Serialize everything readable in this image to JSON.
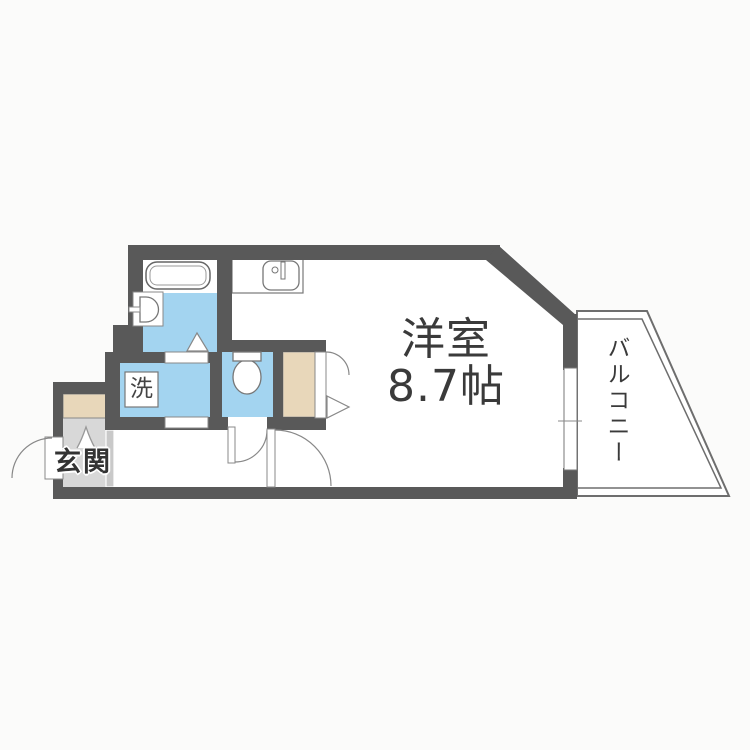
{
  "page": {
    "title": "間取り図"
  },
  "rooms": {
    "main": {
      "name": "洋室",
      "size": "8.7帖"
    },
    "balcony": {
      "name": "バルコニー"
    },
    "entrance": {
      "name": "玄関"
    },
    "laundry": {
      "label": "洗"
    }
  },
  "fixtures": {
    "bathtub": "bathtub-icon",
    "washbasin": "washbasin-icon",
    "kitchen_sink": "kitchen-sink-icon",
    "toilet": "toilet-icon",
    "shoe_cabinet": "shoe-cabinet",
    "closet": "closet",
    "window": "sliding-window",
    "doors": [
      "entrance-door",
      "bathroom-folding-door",
      "washroom-sliding-door",
      "toilet-door",
      "main-room-door",
      "closet-folding-door"
    ]
  },
  "colors": {
    "wall": "#595959",
    "wet_area_floor": "#a3d4f0",
    "closet_floor": "#e8d7ba",
    "entrance_floor": "#d8d8d8",
    "step_strip": "#c9c9c9",
    "background": "#fbfbfa",
    "line": "#777777"
  }
}
